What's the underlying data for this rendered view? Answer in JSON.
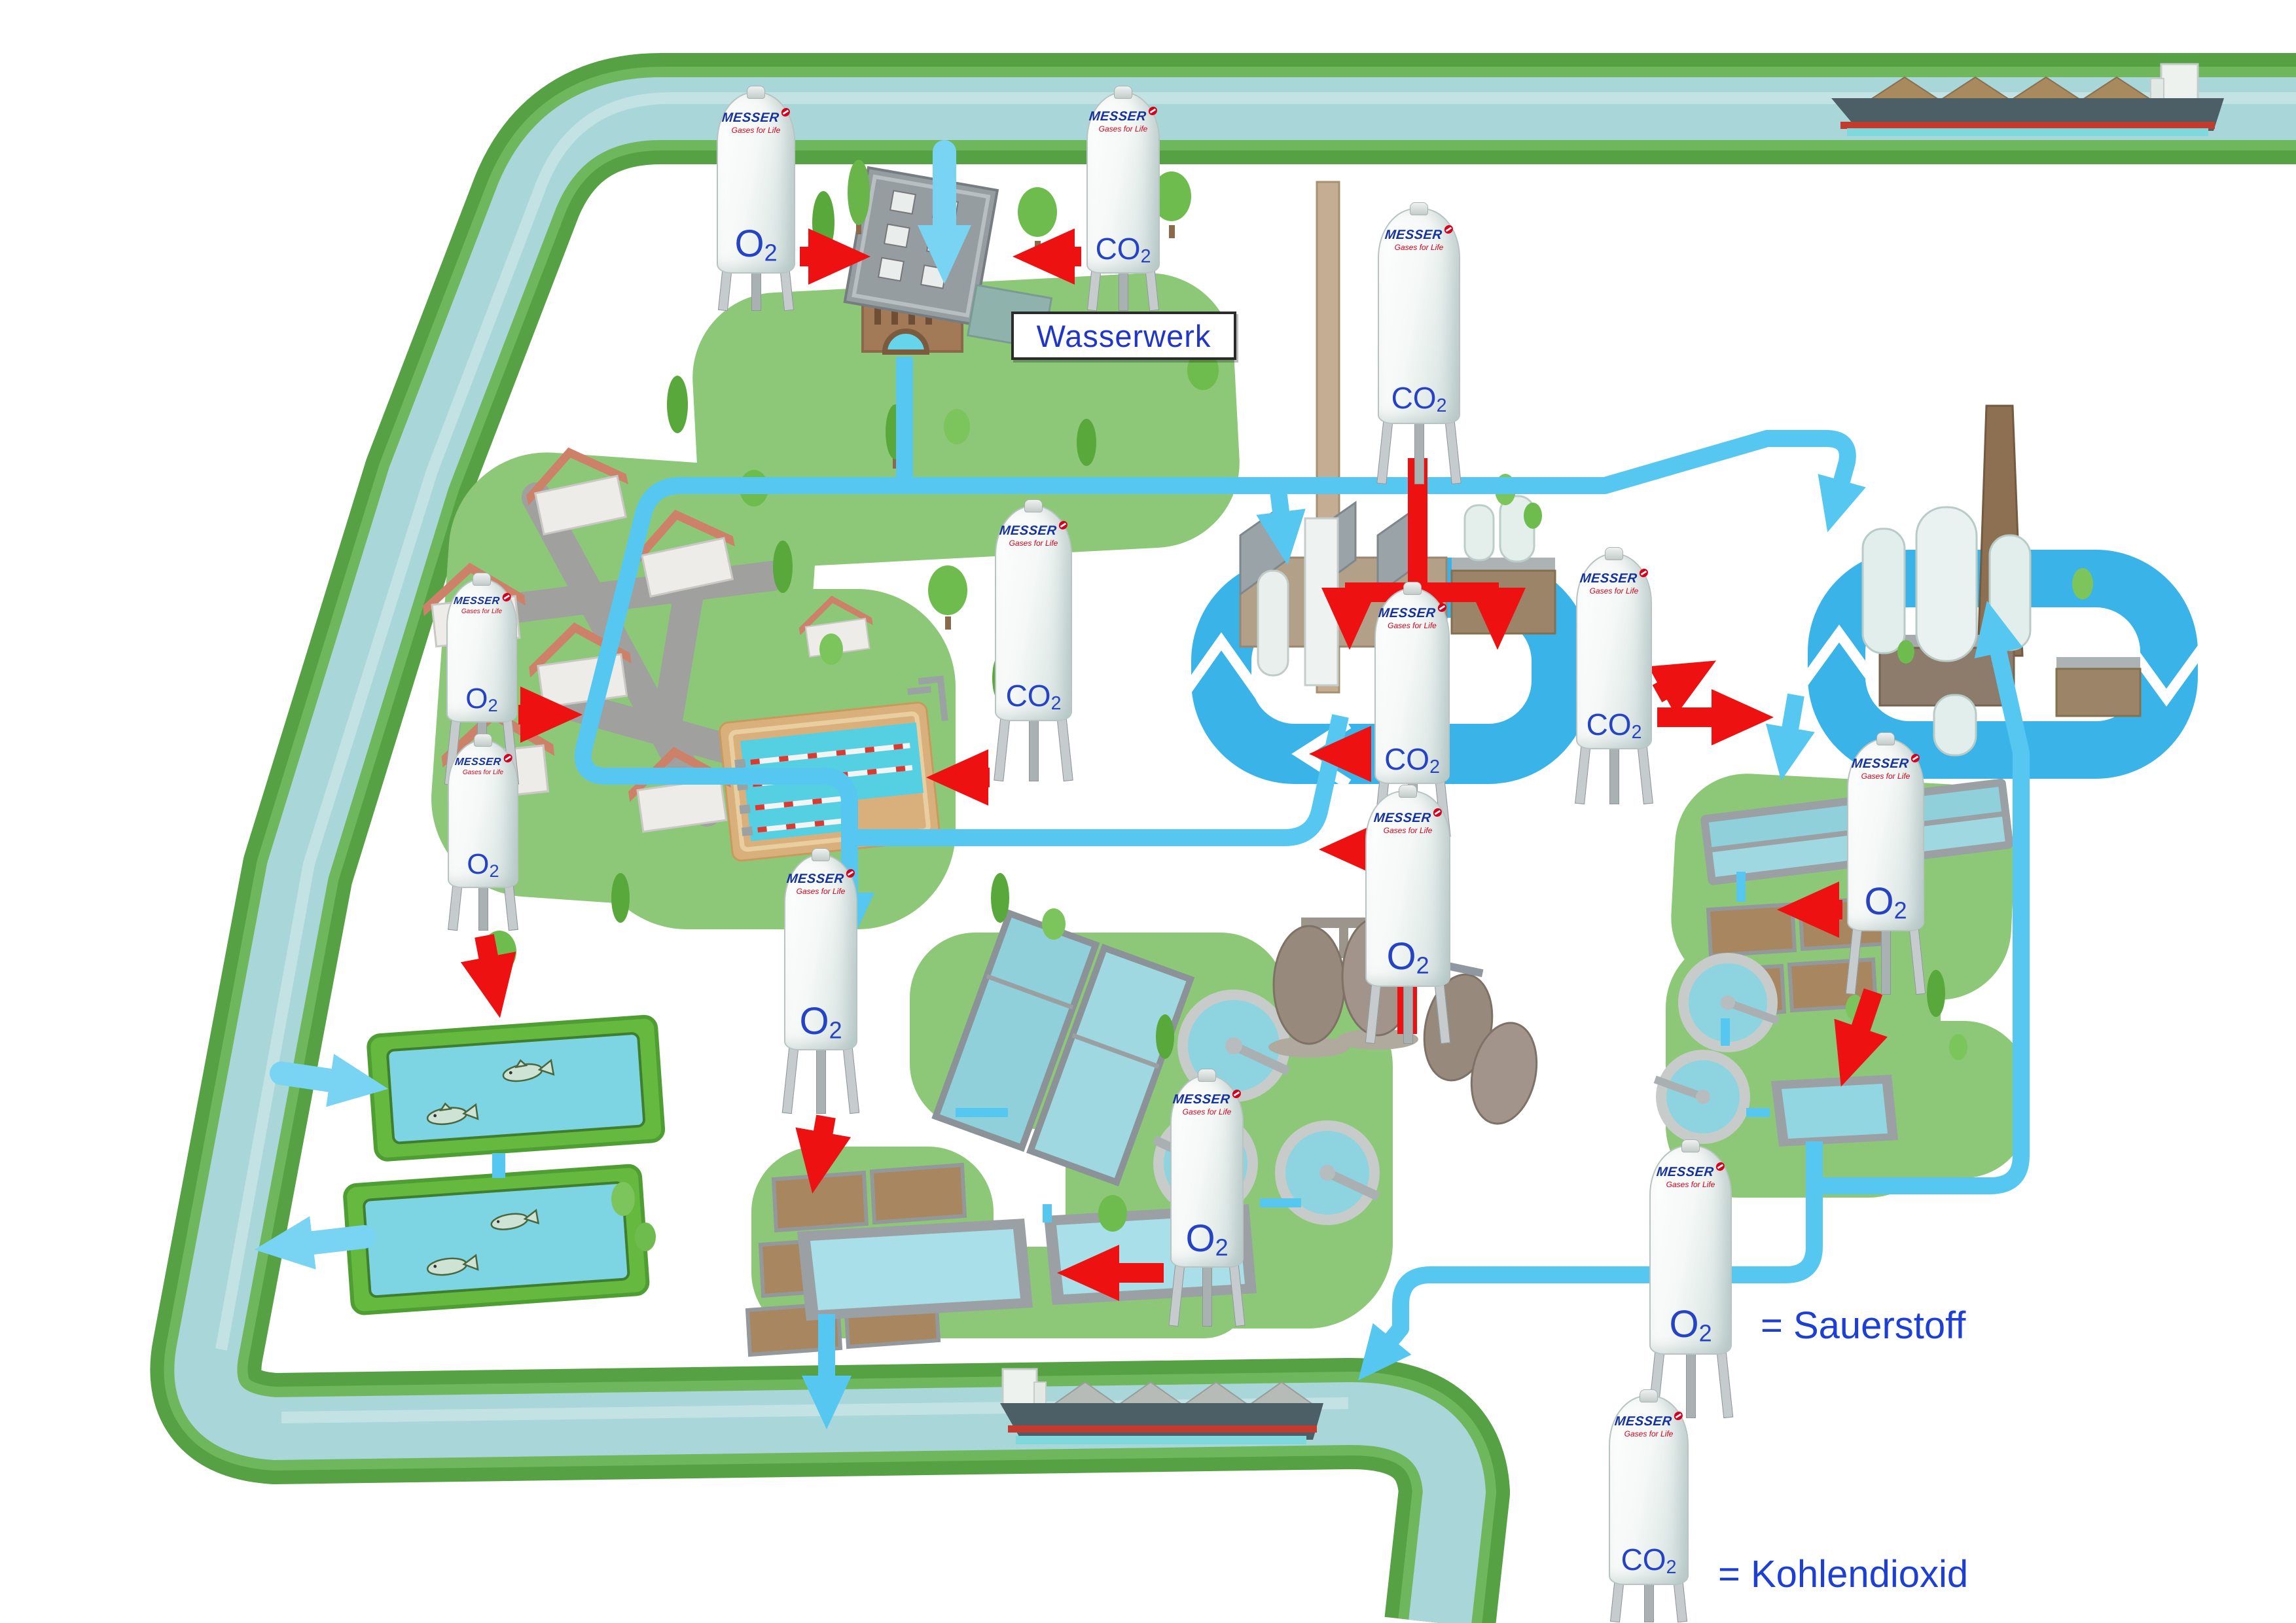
{
  "brand": {
    "name": "MESSER",
    "tagline": "Gases for Life"
  },
  "gases": {
    "o2": {
      "symbol": "O",
      "subscript": "2"
    },
    "co2": {
      "symbol": "CO",
      "subscript": "2"
    }
  },
  "labels": {
    "waterworks_sign": "Wasserwerk"
  },
  "legend": {
    "o2": "= Sauerstoff",
    "co2": "= Kohlendioxid"
  },
  "tanks": [
    {
      "id": "o2-waterworks",
      "gas": "O2"
    },
    {
      "id": "co2-waterworks",
      "gas": "CO2"
    },
    {
      "id": "co2-factory",
      "gas": "CO2"
    },
    {
      "id": "co2-pool",
      "gas": "CO2"
    },
    {
      "id": "o2-village-upper",
      "gas": "O2"
    },
    {
      "id": "o2-village-lower",
      "gas": "O2"
    },
    {
      "id": "co2-mid-factory",
      "gas": "CO2"
    },
    {
      "id": "o2-mid-factory",
      "gas": "O2"
    },
    {
      "id": "co2-loop-right",
      "gas": "CO2"
    },
    {
      "id": "o2-plant-right",
      "gas": "O2"
    },
    {
      "id": "o2-plant-left",
      "gas": "O2"
    },
    {
      "id": "o2-plant-center",
      "gas": "O2"
    },
    {
      "id": "o2-legend",
      "gas": "O2"
    },
    {
      "id": "co2-legend",
      "gas": "CO2"
    }
  ],
  "icons": {
    "messer-logo-mark": "red circle with white slash",
    "recycle-loop": "blue circular water loop arrows",
    "red-arrow": "gas supply flow",
    "blue-pipe": "water flow",
    "fish": "fish in pond",
    "barge": "cargo ship on river"
  },
  "colors": {
    "river_water": "#a9d6d9",
    "river_bank": "#55a144",
    "pipe_water": "#56c7f0",
    "loop_water": "#3ab4e8",
    "gas_arrow": "#ee1111",
    "site_green": "#8dc878",
    "label_blue": "#2543c4",
    "brand_blue": "#16339b",
    "brand_red": "#d6001c"
  }
}
